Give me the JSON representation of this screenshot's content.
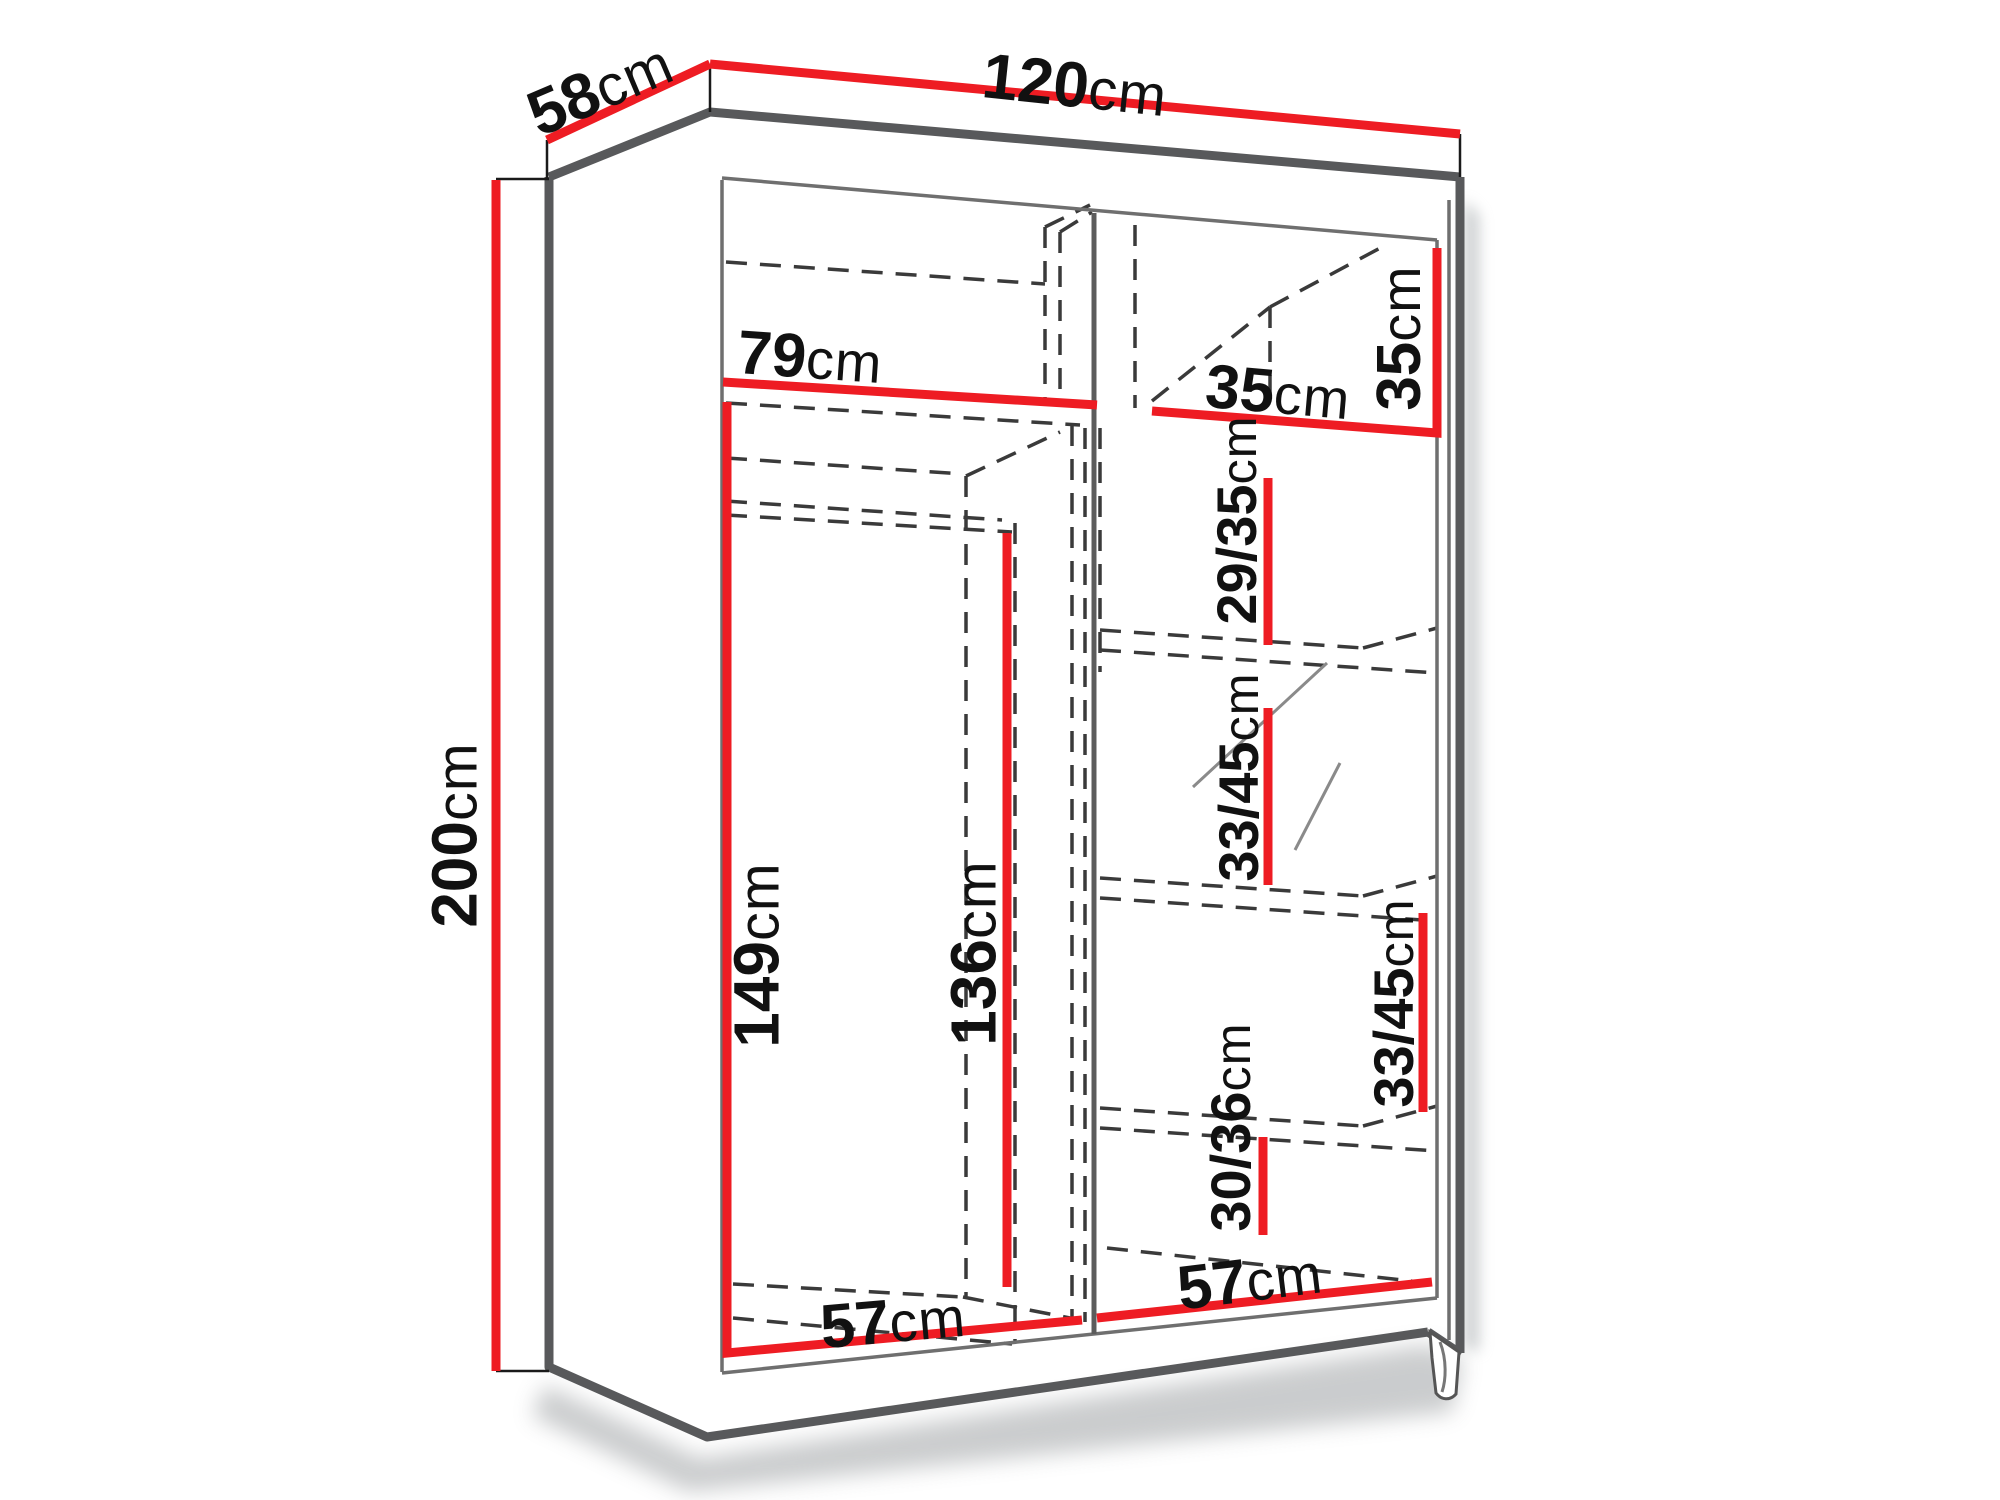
{
  "diagram": {
    "type": "furniture-dimension-diagram",
    "subject": "sliding-door wardrobe shown in perspective with interior shelf layout and measurements",
    "unit": "cm",
    "colors": {
      "dimension_accent": "#ee1c23",
      "outline": "#58595b",
      "hidden_lines": "#3a3a3a",
      "text": "#111111",
      "background": "#ffffff"
    }
  },
  "labels": {
    "depth": {
      "value": "58",
      "unit": "cm"
    },
    "width": {
      "value": "120",
      "unit": "cm"
    },
    "height": {
      "value": "200",
      "unit": "cm"
    },
    "left_top_shelf_width": {
      "value": "79",
      "unit": "cm"
    },
    "right_top_shelf_width": {
      "value": "35",
      "unit": "cm"
    },
    "top_shelf_height": {
      "value": "35",
      "unit": "cm"
    },
    "right_shelf_1_height": {
      "value": "29/35",
      "unit": "cm"
    },
    "right_shelf_2_height": {
      "value": "33/45",
      "unit": "cm"
    },
    "right_shelf_3_height": {
      "value": "33/45",
      "unit": "cm"
    },
    "right_shelf_4_height": {
      "value": "30/36",
      "unit": "cm"
    },
    "left_section_height": {
      "value": "149",
      "unit": "cm"
    },
    "left_inner_height": {
      "value": "136",
      "unit": "cm"
    },
    "left_floor_width": {
      "value": "57",
      "unit": "cm"
    },
    "right_floor_width": {
      "value": "57",
      "unit": "cm"
    }
  }
}
